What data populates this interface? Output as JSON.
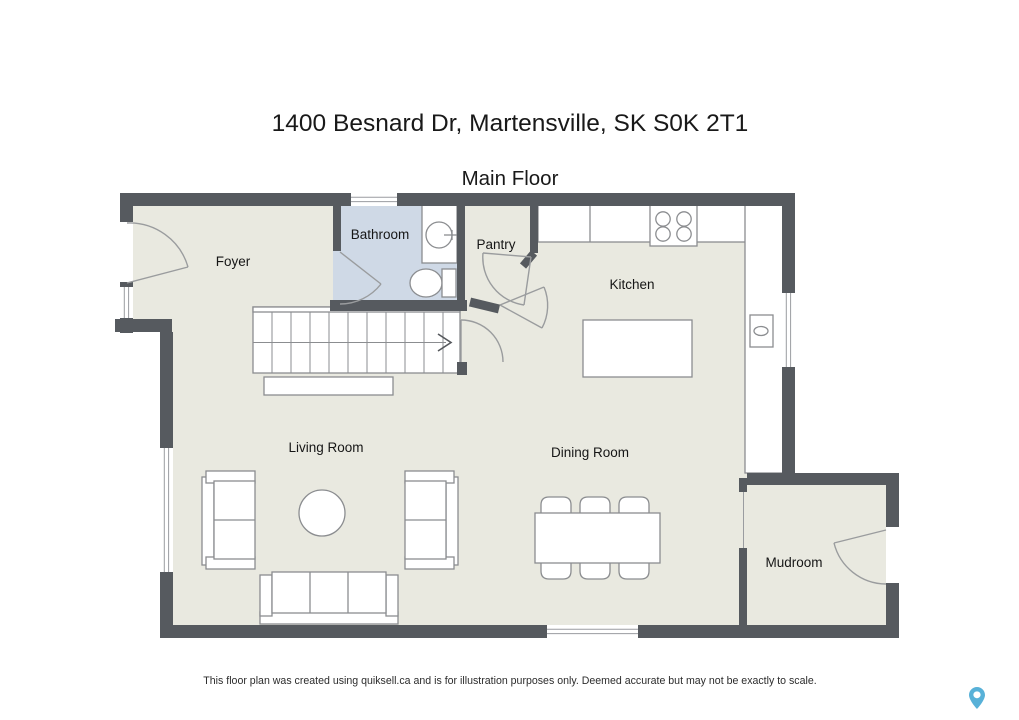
{
  "page": {
    "title": "1400 Besnard Dr, Martensville, SK S0K 2T1",
    "floor_label": "Main Floor",
    "disclaimer": "This floor plan was created using quiksell.ca and is for illustration purposes only. Deemed accurate but may not be exactly to scale."
  },
  "rooms": {
    "foyer": "Foyer",
    "bathroom": "Bathroom",
    "pantry": "Pantry",
    "kitchen": "Kitchen",
    "living_room": "Living Room",
    "dining_room": "Dining Room",
    "mudroom": "Mudroom"
  },
  "fixtures": [
    "entry-door-swing",
    "bathroom-door-swing",
    "pantry-door-swing",
    "kitchen-door-swing",
    "hall-door-swing",
    "mudroom-door-swing",
    "staircase-with-up-arrow",
    "stair-landing",
    "bathroom-vanity-sink",
    "toilet",
    "stove-cooktop",
    "kitchen-counter",
    "kitchen-sink",
    "kitchen-island",
    "dining-table-with-six-chairs",
    "loveseat-left",
    "loveseat-right",
    "sofa",
    "round-coffee-table",
    "window",
    "cased-opening",
    "map-pin-watermark"
  ],
  "colors": {
    "wall": "#565a5f",
    "floor": "#e9e9e0",
    "bathroom_floor": "#cfd9e6",
    "fixture_line": "#8b8d90",
    "text": "#191919",
    "watermark_pin": "#58b1d8",
    "background": "#ffffff"
  }
}
